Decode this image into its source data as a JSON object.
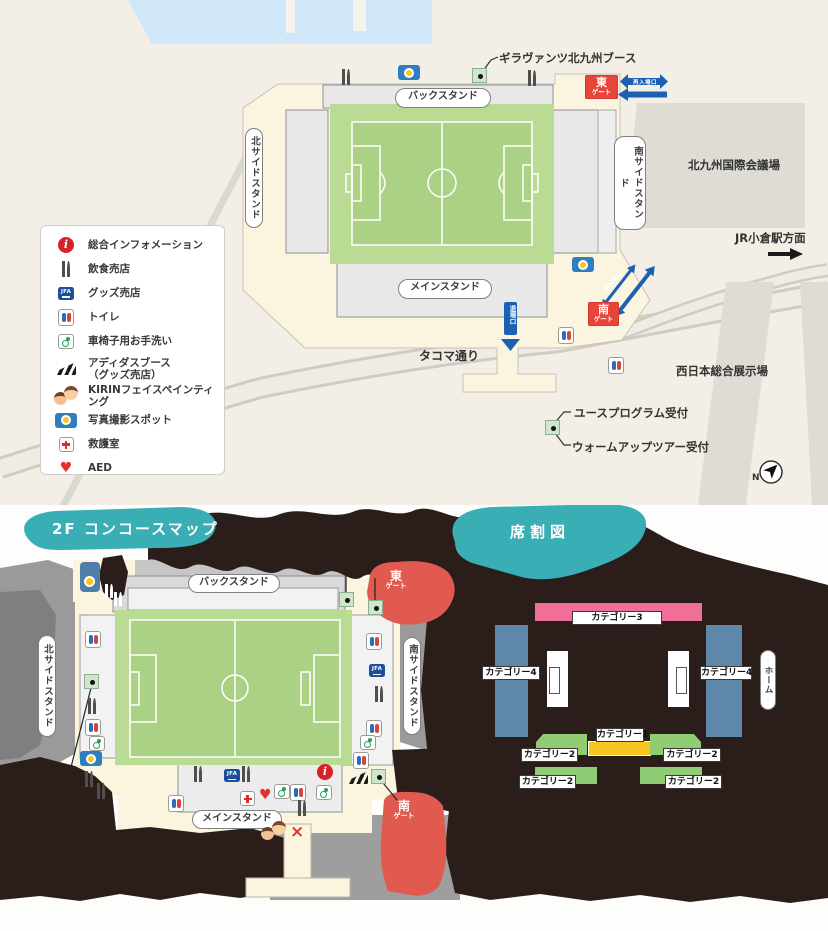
{
  "colors": {
    "background_cream": "#f3efe6",
    "concourse_cream": "#fbf4de",
    "water_blue": "#cfe7f8",
    "road_gray": "#dbd8cf",
    "building_gray": "#dedcd5",
    "stand_gray": "#e8e8e8",
    "pitch_green_light": "#b9db93",
    "pitch_green": "#abd284",
    "gate_red": "#e8443a",
    "gate_blob_red": "#e15a50",
    "arrow_blue": "#1b61b3",
    "banner_teal": "#3aaeb5",
    "blob_black": "#2b1e1a",
    "cat1_yellow": "#f6c71f",
    "cat2_green": "#90cc74",
    "cat3_pink": "#ef6f98",
    "cat4_blue": "#5d88a9"
  },
  "legend": {
    "items": [
      {
        "icon": "info",
        "label": "総合インフォメーション"
      },
      {
        "icon": "fork",
        "label": "飲食売店"
      },
      {
        "icon": "jfa",
        "label": "グッズ売店"
      },
      {
        "icon": "toilet",
        "label": "トイレ"
      },
      {
        "icon": "wheel",
        "label": "車椅子用お手洗い"
      },
      {
        "icon": "adidas",
        "label": "アディダスブース",
        "sublabel": "（グッズ売店）"
      },
      {
        "icon": "kirin",
        "label": "KIRINフェイスペインティング"
      },
      {
        "icon": "camera",
        "label": "写真撮影スポット"
      },
      {
        "icon": "aid",
        "label": "救護室"
      },
      {
        "icon": "aed",
        "label": "AED"
      }
    ]
  },
  "stadium": {
    "back_stand": "バックスタンド",
    "main_stand": "メインスタンド",
    "north_stand": "北サイドスタンド",
    "south_stand": "南サイドスタンド",
    "east_gate_char": "東",
    "south_gate_char": "南",
    "gate_word": "ゲート"
  },
  "top_map": {
    "booth_callout": "ギラヴァンツ北九州ブース",
    "reentry": "再入場口",
    "reentry2": "再入場口",
    "exit_gate": "退場口",
    "conference_center": "北九州国際会議場",
    "station_direction": "JR小倉駅方面",
    "street": "タコマ通り",
    "exhibition_center": "西日本総合展示場",
    "youth_reception": "ユースプログラム受付",
    "warmup_reception": "ウォームアップツアー受付",
    "compass_n": "N",
    "markers": [
      {
        "t": "camera",
        "x": 398,
        "y": 65
      },
      {
        "t": "fork",
        "x": 341,
        "y": 69
      },
      {
        "t": "booth",
        "x": 472,
        "y": 68
      },
      {
        "t": "fork",
        "x": 527,
        "y": 70
      },
      {
        "t": "camera",
        "x": 572,
        "y": 257
      },
      {
        "t": "toilet",
        "x": 558,
        "y": 327
      },
      {
        "t": "toilet",
        "x": 608,
        "y": 357
      },
      {
        "t": "booth",
        "x": 545,
        "y": 420
      }
    ]
  },
  "concourse_map": {
    "title": "2F コンコースマップ",
    "markers": [
      {
        "t": "camera2",
        "x": 80,
        "y": 562
      },
      {
        "t": "forkw",
        "x": 104,
        "y": 584
      },
      {
        "t": "forkw",
        "x": 113,
        "y": 592
      },
      {
        "t": "toilet",
        "x": 85,
        "y": 631
      },
      {
        "t": "booth",
        "x": 84,
        "y": 674
      },
      {
        "t": "fork",
        "x": 87,
        "y": 698
      },
      {
        "t": "toilet",
        "x": 85,
        "y": 719
      },
      {
        "t": "wheel",
        "x": 89,
        "y": 736
      },
      {
        "t": "camera",
        "x": 80,
        "y": 751
      },
      {
        "t": "fork",
        "x": 84,
        "y": 771
      },
      {
        "t": "fork",
        "x": 96,
        "y": 783
      },
      {
        "t": "booth",
        "x": 339,
        "y": 592
      },
      {
        "t": "booth",
        "x": 368,
        "y": 600
      },
      {
        "t": "toilet",
        "x": 366,
        "y": 633
      },
      {
        "t": "jfa",
        "x": 369,
        "y": 664
      },
      {
        "t": "fork",
        "x": 374,
        "y": 686
      },
      {
        "t": "toilet",
        "x": 366,
        "y": 720
      },
      {
        "t": "wheel",
        "x": 360,
        "y": 735
      },
      {
        "t": "toilet",
        "x": 353,
        "y": 752
      },
      {
        "t": "fork",
        "x": 193,
        "y": 766
      },
      {
        "t": "jfa",
        "x": 224,
        "y": 769
      },
      {
        "t": "fork",
        "x": 241,
        "y": 766
      },
      {
        "t": "toilet",
        "x": 168,
        "y": 795
      },
      {
        "t": "aid",
        "x": 240,
        "y": 791
      },
      {
        "t": "aed",
        "x": 259,
        "y": 788
      },
      {
        "t": "wheel",
        "x": 274,
        "y": 784
      },
      {
        "t": "toilet",
        "x": 290,
        "y": 784
      },
      {
        "t": "fork",
        "x": 297,
        "y": 800
      },
      {
        "t": "info",
        "x": 317,
        "y": 764
      },
      {
        "t": "wheel",
        "x": 316,
        "y": 785
      },
      {
        "t": "adidas",
        "x": 348,
        "y": 771
      },
      {
        "t": "booth",
        "x": 371,
        "y": 769
      },
      {
        "t": "kirin",
        "x": 261,
        "y": 821
      },
      {
        "t": "cross",
        "x": 290,
        "y": 824
      }
    ]
  },
  "seat_map": {
    "title": "席割図",
    "cat1": "カテゴリー1",
    "cat2": "カテゴリー2",
    "cat3": "カテゴリー3",
    "cat4": "カテゴリー4",
    "home": "ホーム"
  },
  "icon_text": {
    "jfa": "JFA",
    "info": "i",
    "aed": "♥",
    "cross": "×"
  }
}
